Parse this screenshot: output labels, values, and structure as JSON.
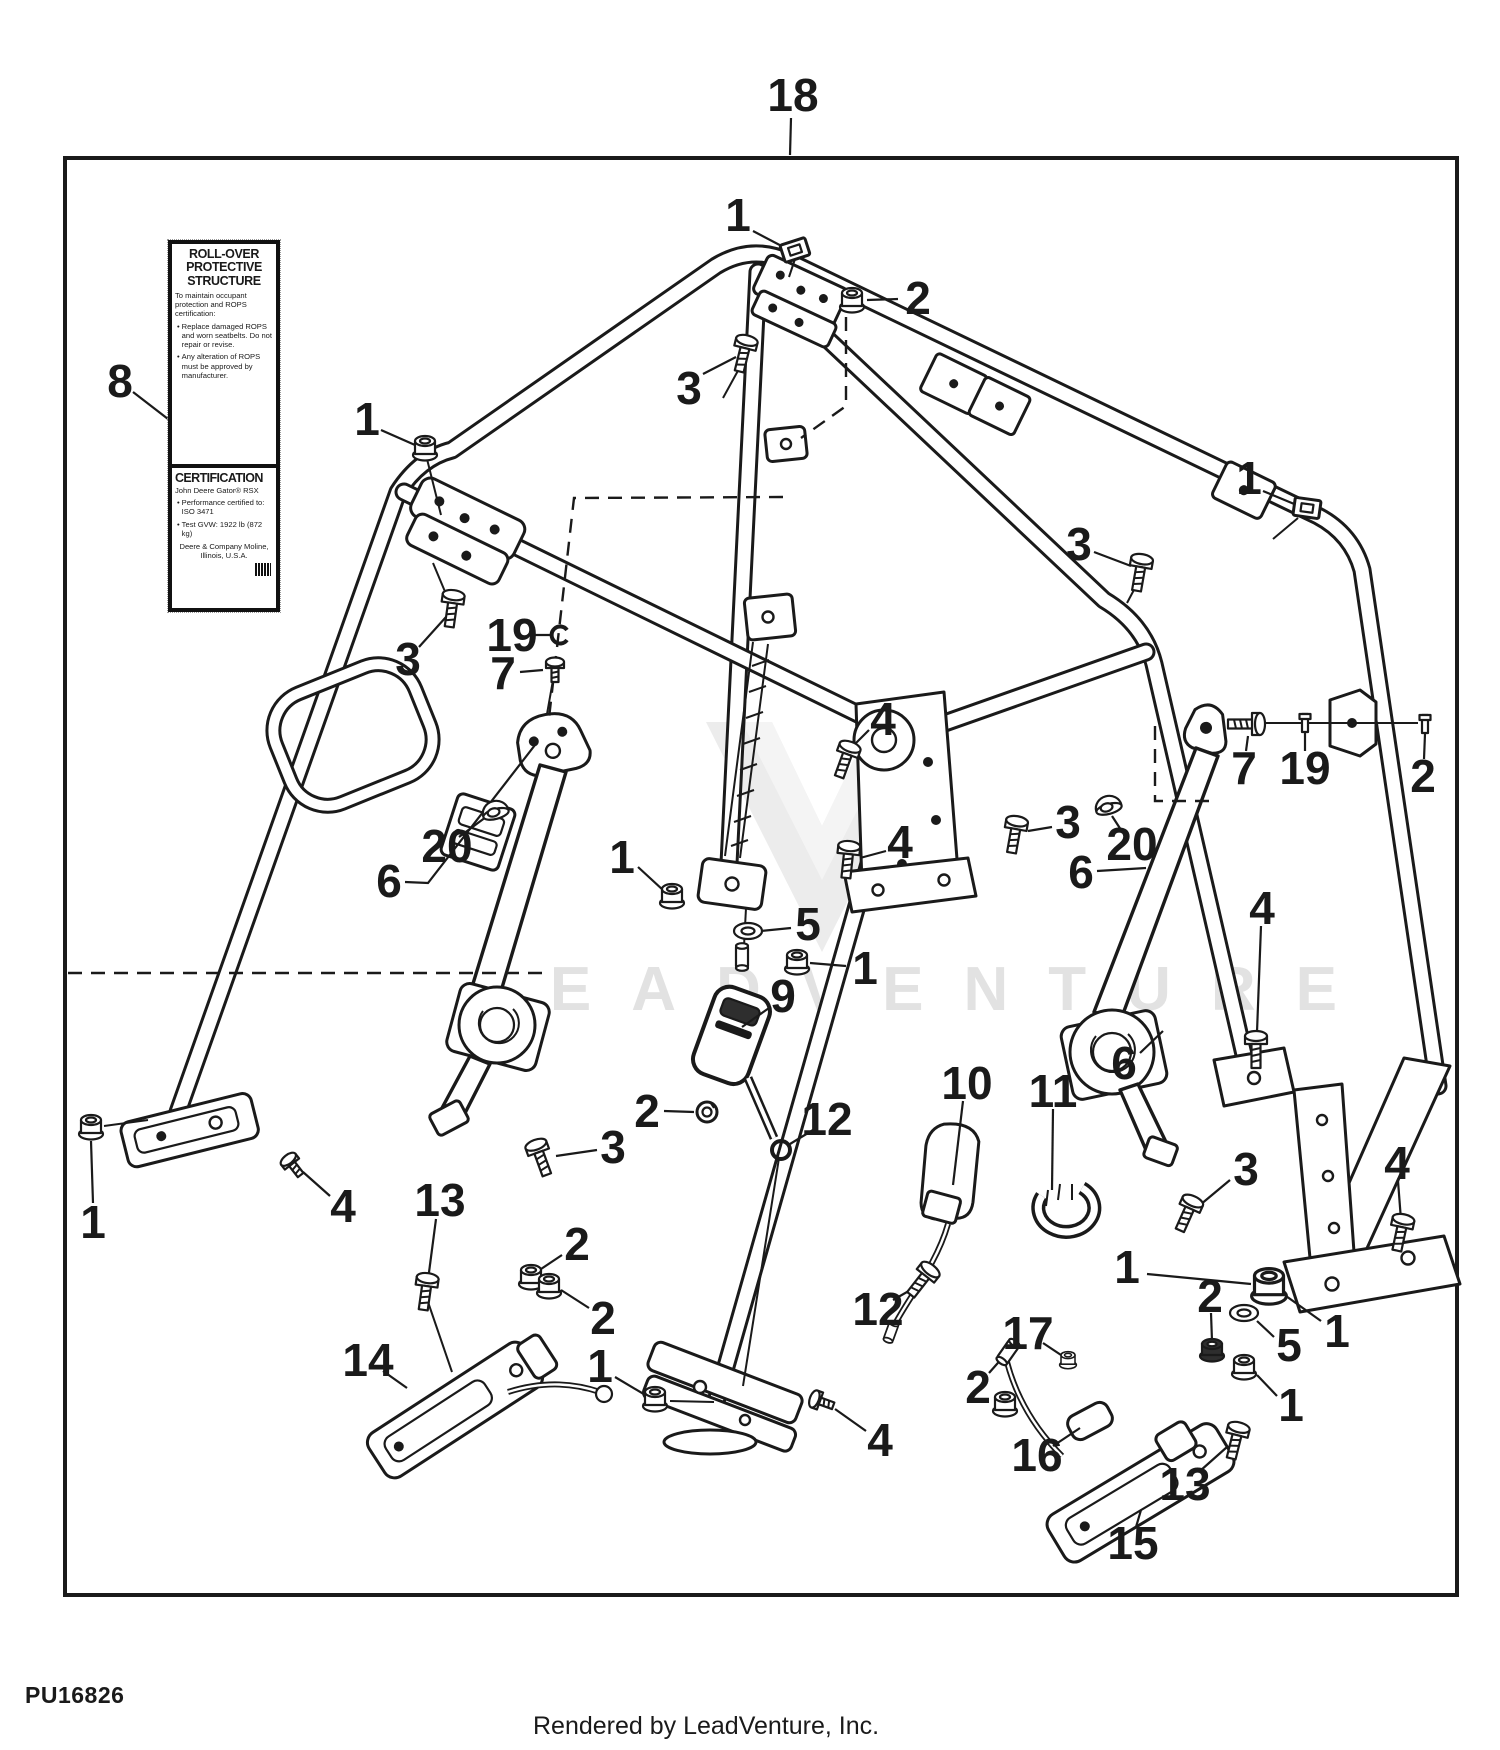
{
  "page": {
    "background": "#ffffff",
    "ink": "#1a1a1a",
    "watermark_color": "#e2e2e2"
  },
  "footer": {
    "part_number": "PU16826",
    "credit": "Rendered by LeadVenture, Inc."
  },
  "watermark": {
    "text": "LEADVENTURE"
  },
  "safety_label": {
    "title_lines": [
      "ROLL-OVER",
      "PROTECTIVE",
      "STRUCTURE"
    ],
    "intro": "To maintain occupant protection and ROPS certification:",
    "bullets": [
      "Replace damaged ROPS and worn seatbelts. Do not repair or revise.",
      "Any alteration of ROPS must be approved by manufacturer."
    ],
    "cert_title": "CERTIFICATION",
    "cert_model": "John Deere Gator® RSX",
    "cert_bullets": [
      "Performance certified to: ISO 3471",
      "Test GVW: 1922 lb (872 kg)"
    ],
    "cert_footer": "Deere & Company Moline, Illinois, U.S.A."
  },
  "diagram": {
    "frame": {
      "x": 65,
      "y": 158,
      "w": 1392,
      "h": 1437
    },
    "callouts": [
      {
        "n": "18",
        "x": 793,
        "y": 95,
        "lead": [
          [
            791,
            118
          ],
          [
            790,
            155
          ]
        ]
      },
      {
        "n": "1",
        "x": 738,
        "y": 215,
        "lead": [
          [
            753,
            231
          ],
          [
            793,
            252
          ]
        ]
      },
      {
        "n": "2",
        "x": 918,
        "y": 298,
        "lead": [
          [
            898,
            299
          ],
          [
            867,
            300
          ]
        ]
      },
      {
        "n": "3",
        "x": 689,
        "y": 388,
        "lead": [
          [
            703,
            374
          ],
          [
            736,
            357
          ]
        ]
      },
      {
        "n": "1",
        "x": 1249,
        "y": 478,
        "lead": [
          [
            1263,
            491
          ],
          [
            1299,
            506
          ]
        ]
      },
      {
        "n": "3",
        "x": 1079,
        "y": 544,
        "lead": [
          [
            1094,
            552
          ],
          [
            1131,
            566
          ]
        ]
      },
      {
        "n": "8",
        "x": 120,
        "y": 381,
        "lead": [
          [
            133,
            392
          ],
          [
            168,
            419
          ]
        ]
      },
      {
        "n": "1",
        "x": 367,
        "y": 419,
        "lead": [
          [
            381,
            430
          ],
          [
            415,
            445
          ]
        ]
      },
      {
        "n": "3",
        "x": 408,
        "y": 659,
        "lead": [
          [
            419,
            647
          ],
          [
            446,
            617
          ]
        ]
      },
      {
        "n": "19",
        "x": 512,
        "y": 635,
        "lead": [
          [
            534,
            635
          ],
          [
            551,
            635
          ]
        ]
      },
      {
        "n": "7",
        "x": 503,
        "y": 673,
        "lead": [
          [
            520,
            672
          ],
          [
            543,
            670
          ]
        ]
      },
      {
        "n": "6",
        "x": 389,
        "y": 881,
        "lead": [
          [
            405,
            882
          ],
          [
            428,
            883
          ],
          [
            535,
            745
          ]
        ]
      },
      {
        "n": "20",
        "x": 447,
        "y": 846,
        "lead": [
          [
            459,
            837
          ],
          [
            486,
            817
          ]
        ]
      },
      {
        "n": "4",
        "x": 883,
        "y": 719,
        "lead": [
          [
            869,
            730
          ],
          [
            847,
            752
          ]
        ]
      },
      {
        "n": "4",
        "x": 900,
        "y": 842,
        "lead": [
          [
            886,
            851
          ],
          [
            860,
            858
          ]
        ]
      },
      {
        "n": "1",
        "x": 622,
        "y": 857,
        "lead": [
          [
            638,
            867
          ],
          [
            663,
            890
          ]
        ]
      },
      {
        "n": "5",
        "x": 808,
        "y": 924,
        "lead": [
          [
            791,
            928
          ],
          [
            761,
            931
          ]
        ]
      },
      {
        "n": "1",
        "x": 865,
        "y": 968,
        "lead": [
          [
            846,
            966
          ],
          [
            810,
            963
          ]
        ]
      },
      {
        "n": "9",
        "x": 783,
        "y": 996,
        "lead": [
          [
            769,
            1008
          ],
          [
            742,
            1027
          ]
        ]
      },
      {
        "n": "2",
        "x": 647,
        "y": 1111,
        "lead": [
          [
            664,
            1111
          ],
          [
            694,
            1112
          ]
        ]
      },
      {
        "n": "12",
        "x": 827,
        "y": 1119,
        "lead": [
          [
            813,
            1130
          ],
          [
            790,
            1144
          ]
        ]
      },
      {
        "n": "3",
        "x": 613,
        "y": 1147,
        "lead": [
          [
            597,
            1150
          ],
          [
            556,
            1156
          ]
        ]
      },
      {
        "n": "10",
        "x": 967,
        "y": 1083,
        "lead": [
          [
            963,
            1101
          ],
          [
            953,
            1185
          ]
        ]
      },
      {
        "n": "11",
        "x": 1053,
        "y": 1091,
        "lead": [
          [
            1053,
            1109
          ],
          [
            1052,
            1190
          ]
        ]
      },
      {
        "n": "7",
        "x": 1244,
        "y": 768,
        "lead": [
          [
            1246,
            751
          ],
          [
            1248,
            736
          ]
        ]
      },
      {
        "n": "19",
        "x": 1305,
        "y": 768,
        "lead": [
          [
            1305,
            751
          ],
          [
            1305,
            733
          ]
        ]
      },
      {
        "n": "2",
        "x": 1423,
        "y": 776,
        "lead": [
          [
            1424,
            759
          ],
          [
            1425,
            734
          ]
        ]
      },
      {
        "n": "20",
        "x": 1132,
        "y": 844,
        "lead": [
          [
            1123,
            833
          ],
          [
            1112,
            816
          ]
        ]
      },
      {
        "n": "6",
        "x": 1081,
        "y": 872,
        "lead": [
          [
            1097,
            871
          ],
          [
            1146,
            868
          ]
        ]
      },
      {
        "n": "6",
        "x": 1124,
        "y": 1063,
        "lead": [
          [
            1140,
            1053
          ],
          [
            1163,
            1031
          ]
        ]
      },
      {
        "n": "3",
        "x": 1068,
        "y": 822,
        "lead": [
          [
            1052,
            827
          ],
          [
            1028,
            831
          ]
        ]
      },
      {
        "n": "4",
        "x": 1262,
        "y": 908,
        "lead": [
          [
            1261,
            926
          ],
          [
            1257,
            1032
          ]
        ]
      },
      {
        "n": "2",
        "x": 577,
        "y": 1244,
        "lead": [
          [
            562,
            1255
          ],
          [
            538,
            1271
          ]
        ]
      },
      {
        "n": "2",
        "x": 603,
        "y": 1318,
        "lead": [
          [
            589,
            1308
          ],
          [
            561,
            1290
          ]
        ]
      },
      {
        "n": "1",
        "x": 600,
        "y": 1366,
        "lead": [
          [
            615,
            1377
          ],
          [
            647,
            1396
          ]
        ]
      },
      {
        "n": "1",
        "x": 93,
        "y": 1222,
        "lead": [
          [
            93,
            1203
          ],
          [
            91,
            1141
          ]
        ]
      },
      {
        "n": "4",
        "x": 343,
        "y": 1206,
        "lead": [
          [
            330,
            1196
          ],
          [
            303,
            1172
          ]
        ]
      },
      {
        "n": "13",
        "x": 440,
        "y": 1200,
        "lead": [
          [
            436,
            1219
          ],
          [
            428,
            1280
          ]
        ]
      },
      {
        "n": "14",
        "x": 368,
        "y": 1360,
        "lead": [
          [
            383,
            1371
          ],
          [
            407,
            1388
          ]
        ]
      },
      {
        "n": "12",
        "x": 878,
        "y": 1309,
        "lead": [
          [
            893,
            1300
          ],
          [
            914,
            1288
          ]
        ]
      },
      {
        "n": "2",
        "x": 978,
        "y": 1387,
        "lead": [
          [
            989,
            1373
          ],
          [
            1004,
            1356
          ]
        ]
      },
      {
        "n": "17",
        "x": 1028,
        "y": 1333,
        "lead": [
          [
            1043,
            1343
          ],
          [
            1061,
            1355
          ]
        ]
      },
      {
        "n": "16",
        "x": 1037,
        "y": 1455,
        "lead": [
          [
            1053,
            1446
          ],
          [
            1080,
            1428
          ]
        ]
      },
      {
        "n": "2",
        "x": 1210,
        "y": 1296,
        "lead": [
          [
            1211,
            1313
          ],
          [
            1212,
            1341
          ]
        ]
      },
      {
        "n": "1",
        "x": 1127,
        "y": 1267,
        "lead": [
          [
            1147,
            1274
          ],
          [
            1251,
            1284
          ]
        ]
      },
      {
        "n": "5",
        "x": 1289,
        "y": 1345,
        "lead": [
          [
            1274,
            1337
          ],
          [
            1257,
            1321
          ]
        ]
      },
      {
        "n": "1",
        "x": 1337,
        "y": 1331,
        "lead": [
          [
            1321,
            1321
          ],
          [
            1286,
            1296
          ]
        ]
      },
      {
        "n": "1",
        "x": 1291,
        "y": 1405,
        "lead": [
          [
            1277,
            1396
          ],
          [
            1257,
            1375
          ]
        ]
      },
      {
        "n": "4",
        "x": 1397,
        "y": 1163,
        "lead": [
          [
            1398,
            1181
          ],
          [
            1401,
            1220
          ]
        ]
      },
      {
        "n": "3",
        "x": 1246,
        "y": 1169,
        "lead": [
          [
            1230,
            1180
          ],
          [
            1200,
            1205
          ]
        ]
      },
      {
        "n": "13",
        "x": 1185,
        "y": 1484,
        "lead": [
          [
            1200,
            1471
          ],
          [
            1227,
            1447
          ]
        ]
      },
      {
        "n": "15",
        "x": 1133,
        "y": 1543,
        "lead": [
          [
            1136,
            1527
          ],
          [
            1141,
            1510
          ]
        ]
      },
      {
        "n": "4",
        "x": 880,
        "y": 1440,
        "lead": [
          [
            866,
            1431
          ],
          [
            835,
            1409
          ]
        ]
      }
    ],
    "fasteners": [
      {
        "t": "clipnut",
        "x": 795,
        "y": 250,
        "r": -18
      },
      {
        "t": "clipnut",
        "x": 1307,
        "y": 508,
        "r": 8
      },
      {
        "t": "nut",
        "x": 425,
        "y": 448,
        "r": 0
      },
      {
        "t": "nut",
        "x": 852,
        "y": 300,
        "r": 0
      },
      {
        "t": "nut",
        "x": 672,
        "y": 896,
        "r": 0
      },
      {
        "t": "nut",
        "x": 797,
        "y": 962,
        "r": 0
      },
      {
        "t": "nut",
        "x": 91,
        "y": 1127,
        "r": 0
      },
      {
        "t": "nut",
        "x": 531,
        "y": 1277,
        "r": 0
      },
      {
        "t": "nut",
        "x": 549,
        "y": 1286,
        "r": 0
      },
      {
        "t": "nut",
        "x": 655,
        "y": 1399,
        "r": 0
      },
      {
        "t": "nut",
        "x": 1244,
        "y": 1367,
        "r": 0
      },
      {
        "t": "nut",
        "x": 1005,
        "y": 1404,
        "r": 0
      },
      {
        "t": "nut",
        "x": 1068,
        "y": 1360,
        "r": 0,
        "s": 0.7
      },
      {
        "t": "nutbig",
        "x": 1269,
        "y": 1286,
        "r": 0
      },
      {
        "t": "nutdark",
        "x": 1212,
        "y": 1350,
        "r": 0
      },
      {
        "t": "bolt",
        "x": 744,
        "y": 352,
        "r": 14
      },
      {
        "t": "bolt",
        "x": 452,
        "y": 607,
        "r": 8
      },
      {
        "t": "bolt",
        "x": 1140,
        "y": 571,
        "r": 10
      },
      {
        "t": "bolt",
        "x": 846,
        "y": 758,
        "r": 20
      },
      {
        "t": "bolt",
        "x": 848,
        "y": 858,
        "r": 6
      },
      {
        "t": "bolt",
        "x": 1015,
        "y": 833,
        "r": 10
      },
      {
        "t": "bolt",
        "x": 1188,
        "y": 1212,
        "r": 24
      },
      {
        "t": "bolt",
        "x": 1256,
        "y": 1048,
        "r": 0
      },
      {
        "t": "bolt",
        "x": 1401,
        "y": 1231,
        "r": 12
      },
      {
        "t": "bolt",
        "x": 540,
        "y": 1156,
        "r": -20
      },
      {
        "t": "bolt",
        "x": 426,
        "y": 1290,
        "r": 8
      },
      {
        "t": "bolt",
        "x": 923,
        "y": 1279,
        "r": 38
      },
      {
        "t": "bolt",
        "x": 1236,
        "y": 1439,
        "r": 14
      },
      {
        "t": "bolt",
        "x": 1248,
        "y": 724,
        "r": 90
      },
      {
        "t": "screw",
        "x": 292,
        "y": 1164,
        "r": -38
      },
      {
        "t": "screw",
        "x": 820,
        "y": 1401,
        "r": -70
      },
      {
        "t": "screw",
        "x": 555,
        "y": 668,
        "r": 0
      },
      {
        "t": "washer",
        "x": 748,
        "y": 931,
        "r": 0
      },
      {
        "t": "washer",
        "x": 1244,
        "y": 1313,
        "r": 0
      },
      {
        "t": "lockwasher",
        "x": 707,
        "y": 1112,
        "r": 0
      },
      {
        "t": "ring",
        "x": 781,
        "y": 1150,
        "r": 0
      },
      {
        "t": "cring",
        "x": 560,
        "y": 635,
        "r": 0
      },
      {
        "t": "pin",
        "x": 1305,
        "y": 723,
        "r": 0
      },
      {
        "t": "pin",
        "x": 1425,
        "y": 724,
        "r": 0
      },
      {
        "t": "cap",
        "x": 495,
        "y": 810,
        "r": -15
      },
      {
        "t": "cap",
        "x": 1108,
        "y": 805,
        "r": -15
      },
      {
        "t": "cyl",
        "x": 742,
        "y": 957,
        "r": 0
      },
      {
        "t": "cyl",
        "x": 1008,
        "y": 1352,
        "r": 35
      },
      {
        "t": "cyl",
        "x": 891,
        "y": 1332,
        "r": 20,
        "s": 0.8
      }
    ]
  }
}
